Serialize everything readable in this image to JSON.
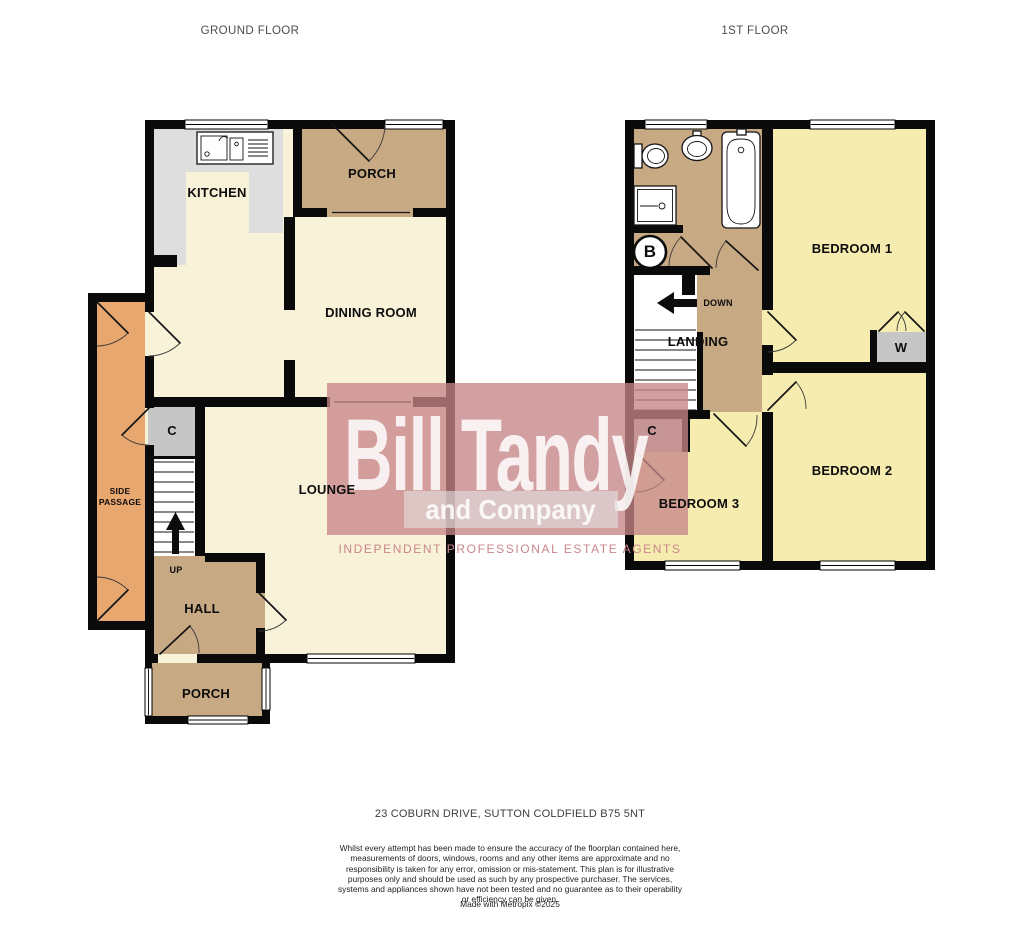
{
  "titles": {
    "ground": "GROUND FLOOR",
    "first": "1ST FLOOR"
  },
  "ground_floor": {
    "kitchen": "KITCHEN",
    "porch_top": "PORCH",
    "dining_room": "DINING ROOM",
    "lounge": "LOUNGE",
    "hall": "HALL",
    "porch_bottom": "PORCH",
    "side_passage": "SIDE PASSAGE",
    "cupboard": "C",
    "up": "UP"
  },
  "first_floor": {
    "bedroom1": "BEDROOM 1",
    "bedroom2": "BEDROOM 2",
    "bedroom3": "BEDROOM 3",
    "landing": "LANDING",
    "down": "DOWN",
    "wardrobe": "W",
    "cupboard": "C",
    "boiler": "B"
  },
  "watermark": {
    "brand": "Bill Tandy",
    "sub": "and Company",
    "tagline": "INDEPENDENT PROFESSIONAL ESTATE AGENTS"
  },
  "footer": {
    "address": "23 COBURN DRIVE, SUTTON COLDFIELD B75 5NT",
    "disclaimer": "Whilst every attempt has been made to ensure the accuracy of the floorplan contained here, measurements of doors, windows, rooms and any other items are approximate and no responsibility is taken for any error, omission or mis-statement. This plan is for illustrative purposes only and should be used as such by any prospective purchaser. The services, systems and appliances shown have not been tested and no guarantee as to their operability or efficiency can be given.",
    "credit": "Made with Metropix ©2025"
  },
  "colors": {
    "wall": "#0a0a0a",
    "cream": "#f8f2d8",
    "tan": "#c7a983",
    "orange": "#e9a770",
    "yellow": "#f6ecb0",
    "gray_cupboard": "#c6c6c6",
    "gray_counter": "#dedede",
    "wm_pink": "rgba(199,133,136,0.78)",
    "wm_band": "rgba(224,222,222,0.62)",
    "wm_text": "rgba(255,255,255,0.85)",
    "wm_tagline": "#c9868a"
  }
}
